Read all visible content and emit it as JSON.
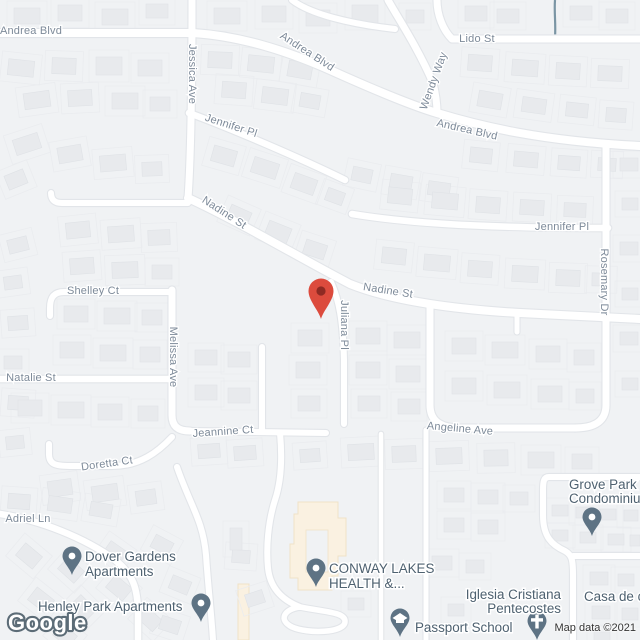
{
  "map": {
    "logo": "Google",
    "attribution": "Map data ©2021",
    "colors": {
      "background": "#F0F2F4",
      "road": "#FFFFFF",
      "street_text": "#7D8A99",
      "poi_text": "#4E6170",
      "poi_marker": "#5E7384",
      "destination_pin": "#DC4B3D",
      "destination_pin_inner": "#8E2A23",
      "creek": "#7A95A4",
      "aoi_building": "#FAF1E1"
    },
    "street_labels": [
      {
        "name": "Andrea Blvd",
        "x": 31,
        "y": 31,
        "rot": 0
      },
      {
        "name": "Andrea Blvd",
        "x": 307,
        "y": 52,
        "rot": 33
      },
      {
        "name": "Andrea Blvd",
        "x": 467,
        "y": 130,
        "rot": 13
      },
      {
        "name": "Lido St",
        "x": 477,
        "y": 39,
        "rot": 0
      },
      {
        "name": "Wendy Way",
        "x": 434,
        "y": 81,
        "rot": -70
      },
      {
        "name": "Jessica Ave",
        "x": 192,
        "y": 74,
        "rot": 90
      },
      {
        "name": "Jennifer Pl",
        "x": 231,
        "y": 126,
        "rot": 18
      },
      {
        "name": "Jennifer Pl",
        "x": 562,
        "y": 227,
        "rot": 0
      },
      {
        "name": "Rosemary Dr",
        "x": 604,
        "y": 282,
        "rot": 90
      },
      {
        "name": "Nadine St",
        "x": 224,
        "y": 213,
        "rot": 33
      },
      {
        "name": "Nadine St",
        "x": 388,
        "y": 291,
        "rot": 9
      },
      {
        "name": "Shelley Ct",
        "x": 93,
        "y": 291,
        "rot": 0
      },
      {
        "name": "Melissa Ave",
        "x": 173,
        "y": 357,
        "rot": 90
      },
      {
        "name": "Natalie St",
        "x": 31,
        "y": 378,
        "rot": 0
      },
      {
        "name": "Juliana Pl",
        "x": 344,
        "y": 325,
        "rot": 90
      },
      {
        "name": "Jeannine Ct",
        "x": 223,
        "y": 432,
        "rot": -4
      },
      {
        "name": "Doretta Ct",
        "x": 107,
        "y": 464,
        "rot": -8
      },
      {
        "name": "Angeline Ave",
        "x": 460,
        "y": 429,
        "rot": 5
      },
      {
        "name": "Adriel Ln",
        "x": 28,
        "y": 519,
        "rot": 0
      }
    ],
    "pois": [
      {
        "name": "Dover Gardens Apartments",
        "lines": [
          "Dover Gardens",
          "Apartments"
        ],
        "anchor": "start",
        "tx": 85,
        "ty": 561,
        "lh": 15,
        "marker": "dot",
        "mx": 72,
        "my": 575
      },
      {
        "name": "Henley Park Apartments",
        "lines": [
          "Henley Park Apartments"
        ],
        "anchor": "start",
        "tx": 38,
        "ty": 611,
        "lh": 15,
        "marker": "dot",
        "mx": 201,
        "my": 622
      },
      {
        "name": "CONWAY LAKES HEALTH &...",
        "lines": [
          "CONWAY LAKES",
          "HEALTH &..."
        ],
        "anchor": "start",
        "tx": 329,
        "ty": 573,
        "lh": 15,
        "marker": "dot",
        "mx": 316,
        "my": 587
      },
      {
        "name": "Passport School",
        "lines": [
          "Passport School"
        ],
        "anchor": "start",
        "tx": 415,
        "ty": 632,
        "lh": 15,
        "marker": "school",
        "mx": 400,
        "my": 637
      },
      {
        "name": "Iglesia Cristiana Pentecostes",
        "lines": [
          "Iglesia Cristiana",
          "Pentecostes"
        ],
        "anchor": "end",
        "tx": 561,
        "ty": 599,
        "lh": 14,
        "marker": "church",
        "mx": 537,
        "my": 640
      },
      {
        "name": "Grove Park Condominiums",
        "lines": [
          "Grove Park",
          "Condominiu"
        ],
        "anchor": "start",
        "tx": 569,
        "ty": 489,
        "lh": 14,
        "marker": "dot",
        "mx": 592,
        "my": 536
      },
      {
        "name": "Casa de c",
        "lines": [
          "Casa de c"
        ],
        "anchor": "start",
        "tx": 584,
        "ty": 601,
        "lh": 14,
        "marker": "none",
        "mx": 0,
        "my": 0
      }
    ],
    "destination_marker": {
      "x": 321,
      "y": 319
    }
  }
}
